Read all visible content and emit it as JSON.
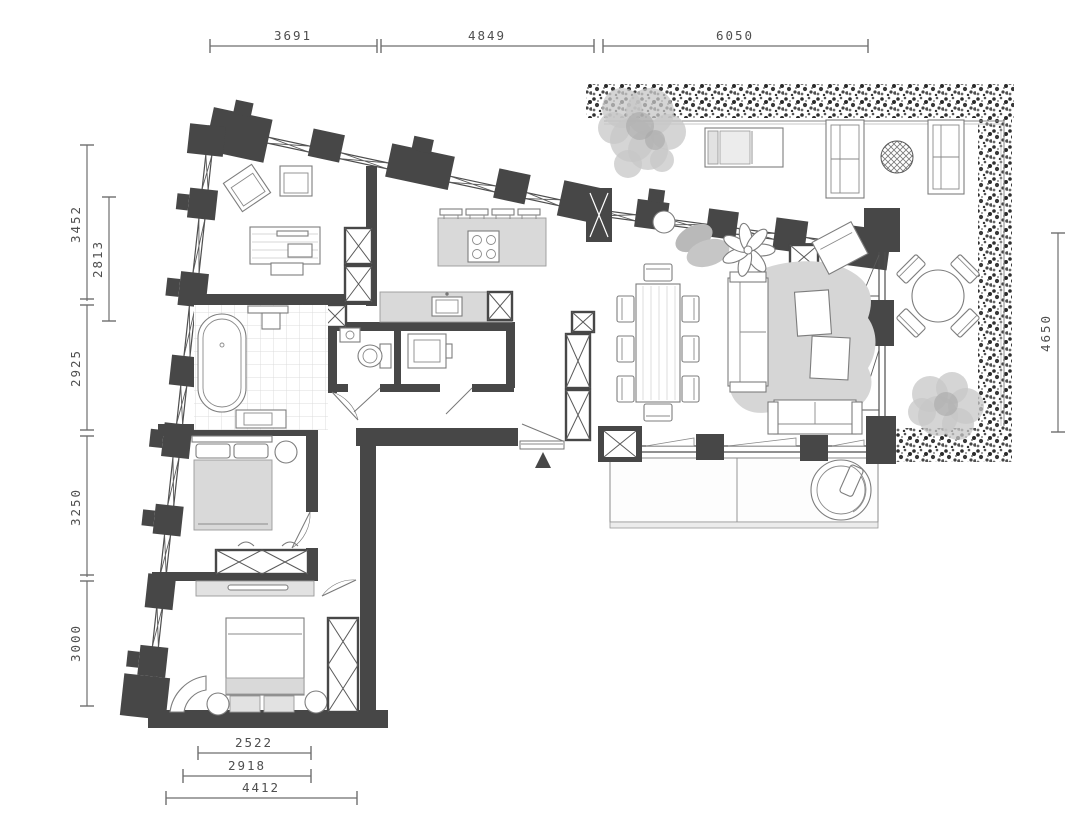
{
  "drawing": {
    "type": "apartment-floor-plan",
    "units": "mm",
    "colors": {
      "wall": "#474747",
      "furniture_line": "#7d7d7d",
      "light_fill": "#d9d9d9",
      "hedge_dot": "#2f2f2f",
      "dimension_text": "#4f4f4f",
      "background": "#ffffff"
    },
    "symbols": [
      {
        "name": "entrance-triangle-marker"
      }
    ],
    "plan_elements": [
      "terrace-hedge",
      "terrace-tree",
      "terrace-shrub",
      "chaise-lounge",
      "outdoor-sofa",
      "woven-side-table",
      "outdoor-round-dining-table",
      "kitchen-island",
      "bar-stools",
      "cooktop",
      "kitchen-counter",
      "sink",
      "dining-table",
      "dining-chairs",
      "sofa",
      "area-rug",
      "coffee-tables",
      "armchair",
      "flower-planter",
      "bathtub",
      "shower",
      "vanity",
      "toilet",
      "wash-basin",
      "washing-machine",
      "wardrobe",
      "double-bed",
      "dresser",
      "papasan-chair",
      "outdoor-platform",
      "entrance-door"
    ]
  },
  "dimensions": {
    "top": [
      {
        "label": "3691"
      },
      {
        "label": "4849"
      },
      {
        "label": "6050"
      }
    ],
    "left_outer": [
      {
        "label": "3452"
      },
      {
        "label": "2925"
      },
      {
        "label": "3250"
      },
      {
        "label": "3000"
      }
    ],
    "left_inner": [
      {
        "label": "2813"
      }
    ],
    "right": [
      {
        "label": "4650"
      }
    ],
    "bottom": [
      {
        "label": "2522"
      },
      {
        "label": "2918"
      },
      {
        "label": "4412"
      }
    ]
  }
}
